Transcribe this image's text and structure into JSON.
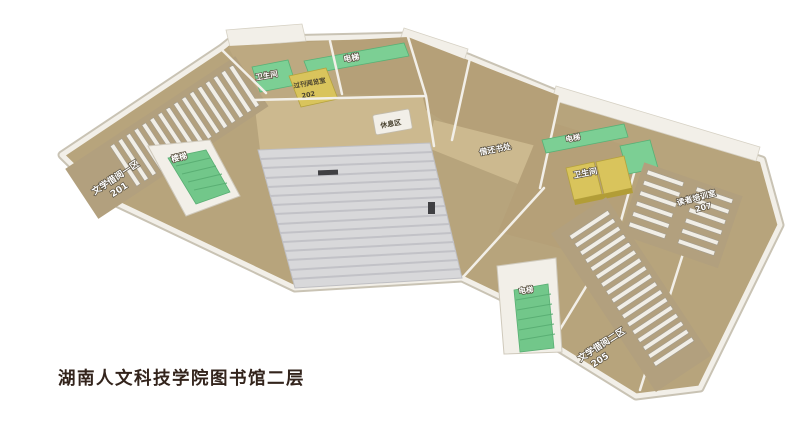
{
  "title": "湖南人文科技学院图书馆二层",
  "rooms": [
    {
      "name": "literature-reading-area-1",
      "label": "文学借阅一区",
      "number": "201"
    },
    {
      "name": "periodical-reading-room",
      "label": "过刊阅览室",
      "number": "202"
    },
    {
      "name": "literature-reading-area-2",
      "label": "文学借阅二区",
      "number": "205"
    },
    {
      "name": "reader-training-room",
      "label": "读者培训室",
      "number": "207"
    },
    {
      "name": "circulation-desk",
      "label": "借还书处",
      "number": ""
    },
    {
      "name": "rest-area",
      "label": "休息区",
      "number": ""
    }
  ],
  "facilities": {
    "stairs_left": "楼梯",
    "elevator_top": "电梯",
    "elevator_right": "电梯",
    "elevator_bottom": "电梯",
    "toilet_left": "卫生间",
    "toilet_right": "卫生间"
  },
  "colors": {
    "floor": "#b7a47c",
    "room_a": "#bda981",
    "room_b": "#b5a078",
    "corridor": "#ccb98f",
    "wing_floor": "#b2a07e",
    "shelf": "#f1eee6",
    "shelf_edge": "#a39c8e",
    "stair_green": "#72c78a",
    "elevator_green": "#7ccf94",
    "green_edge": "#58b176",
    "toilet_yellow": "#d9c45c",
    "yellow_edge": "#b5a23d",
    "atrium_gray": "#d8d8da",
    "atrium_stripe": "#c2c2c7",
    "wall": "#f2efe8",
    "wall_edge": "#cfc9bb",
    "title_text": "#33241c",
    "mark_dark": "#3f3f42"
  }
}
